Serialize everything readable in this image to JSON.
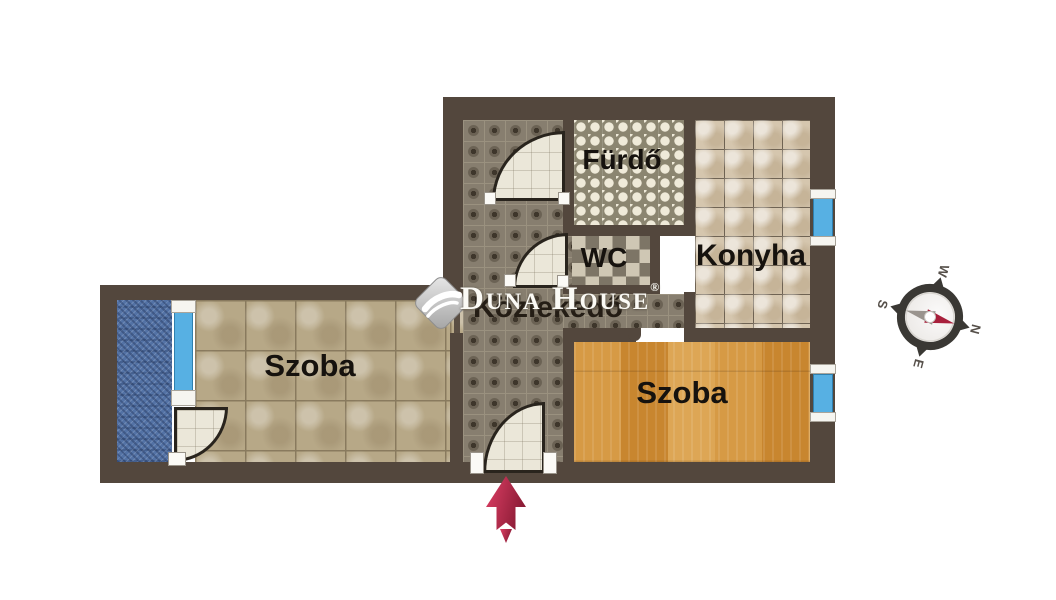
{
  "rooms": {
    "bathroom": "Fürdő",
    "wc": "WC",
    "kitchen": "Konyha",
    "hallway": "Közlekedő",
    "room_left": "Szoba",
    "room_right": "Szoba"
  },
  "watermark": {
    "brand": "Duna House",
    "registered": "®"
  },
  "compass": {
    "north": "N",
    "south": "S",
    "east": "E",
    "west": "W"
  },
  "colors": {
    "wall": "#53473d",
    "window_glass": "#57b0e3",
    "balcony_blue": "#5372a5",
    "wood_floor": "#cf9038",
    "entrance_arrow": "#c22b4e",
    "compass_needle_north": "#a8203c",
    "label_text": "#16120e"
  }
}
